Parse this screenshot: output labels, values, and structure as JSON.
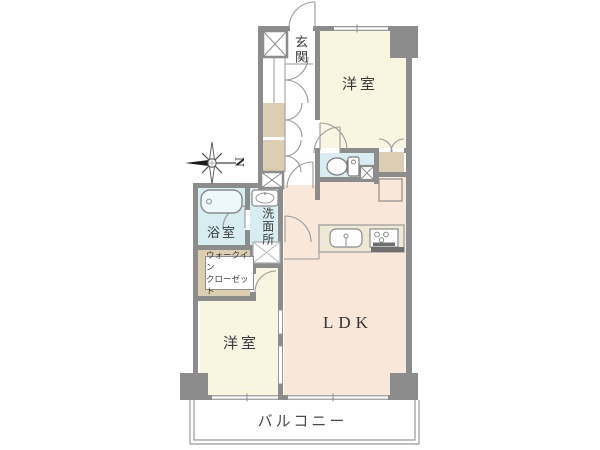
{
  "floorplan": {
    "compass": {
      "north_label": "N"
    },
    "labels": {
      "entrance": "玄関",
      "bedroom_top": "洋室",
      "bedroom_bottom": "洋室",
      "ldk": "LDK",
      "bathroom": "浴室",
      "washroom": "洗面所",
      "walkin_closet_line1": "ウォークイン",
      "walkin_closet_line2": "クローゼット",
      "balcony": "バルコニー"
    },
    "colors": {
      "wall": "#8c8c8c",
      "room_cream": "#f8f5e1",
      "room_peach": "#f9e7da",
      "wet_area_blue": "#d7edf1",
      "closet_tan": "#dccfb1",
      "counter_beige": "#efe8d6",
      "background": "#ffffff"
    }
  }
}
